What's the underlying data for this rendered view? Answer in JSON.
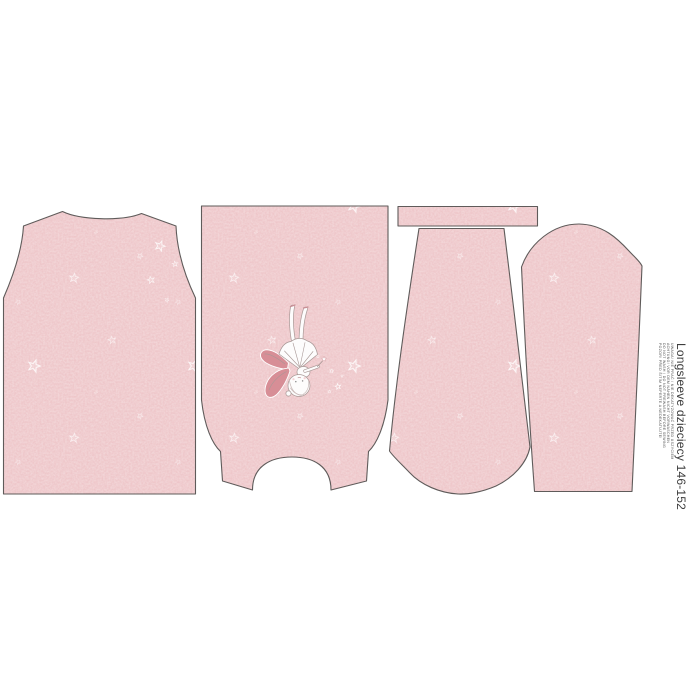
{
  "label": {
    "title": "Longsleeve dzieciecy 146-152",
    "care_lines": [
      "UWAGA! NIE PRAĆ / NIE DEKATYZOWAĆ PRZED USZYCIEM",
      "ACHTUNG! VOR DEM NÄHEN NICHT VORWASCHEN",
      "DO NOT WASH / DO NOT PREWASH BEFORE SEWING",
      "POZOR! PŘED ŠITÍM NEPERTE A NEDEKATUJTE!"
    ]
  },
  "colors": {
    "background": "#ffffff",
    "fabric_base": "#eec6c9",
    "fabric_light": "#f6e1e2",
    "fabric_dark": "#e0acb3",
    "outline": "#5f5b5a",
    "star": "#ffffff",
    "wing": "#d78e96",
    "sketch": "#a89896",
    "label_text": "#3d3d3d",
    "care_text": "#555555"
  },
  "motifs": {
    "print": "scattered-star-motif",
    "graphic": "fairy-with-wand-graphic"
  },
  "pieces": [
    {
      "name": "back-bodice"
    },
    {
      "name": "front-bodice-with-fairy",
      "orientation": "upside-down"
    },
    {
      "name": "neckband-strip"
    },
    {
      "name": "sleeve-left",
      "orientation": "upside-down"
    },
    {
      "name": "sleeve-right"
    }
  ]
}
